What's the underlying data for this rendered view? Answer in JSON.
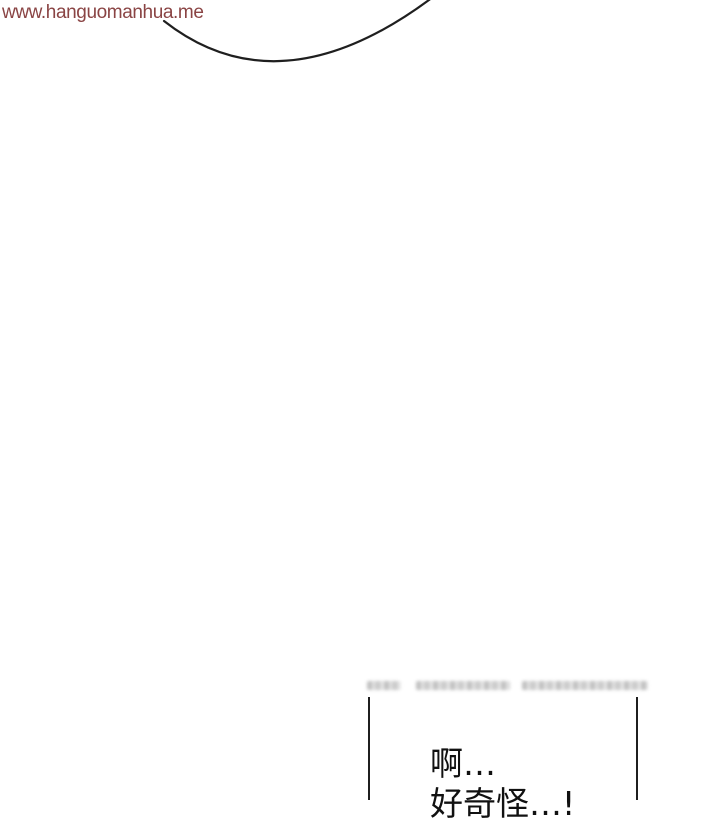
{
  "page": {
    "background_color": "#ffffff",
    "line_art_color": "#1f1f1f"
  },
  "watermark": {
    "text": "www.hanguomanhua.me",
    "color": "#8a4444"
  },
  "artwork": {
    "bubble_arc": "partial speech-bubble outline arc, cut off by top edge"
  },
  "panel": {
    "border_color": "#1f1f1f",
    "blurred_watermark": {
      "illegible": true,
      "description": "blurred-out illegible watermark text strip above panel top edge"
    },
    "dialogue": {
      "lines": [
        "啊…",
        "好奇怪…!"
      ],
      "color": "#111111"
    }
  }
}
